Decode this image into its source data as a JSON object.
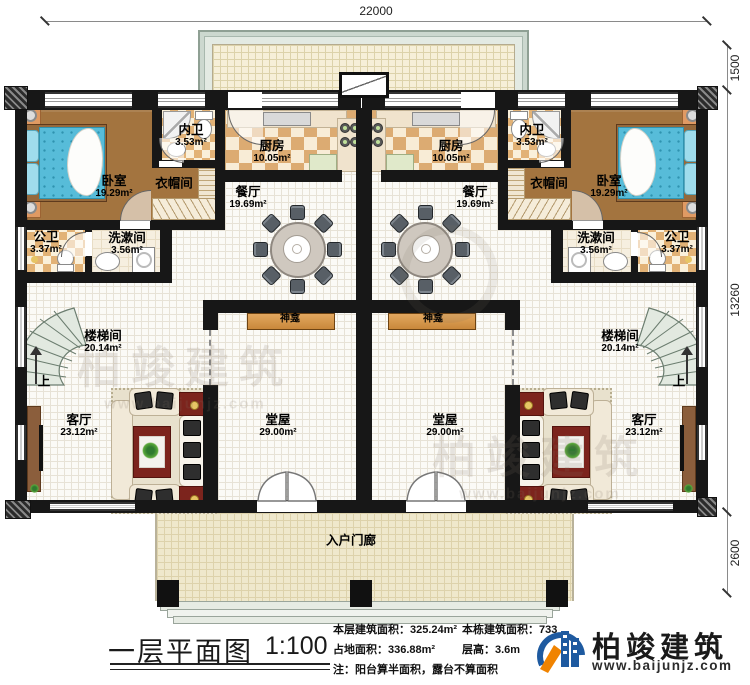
{
  "plan": {
    "title": "一层平面图",
    "scale": "1:100"
  },
  "dimensions": {
    "width_top": "22000",
    "terrace_depth": "1500",
    "body_height": "13260",
    "porch_depth": "2600"
  },
  "rooms": {
    "bedroom": {
      "name": "卧室",
      "area": "19.29m²"
    },
    "inner_bath": {
      "name": "内卫",
      "area": "3.53m²"
    },
    "cloakroom": {
      "name": "衣帽间"
    },
    "kitchen": {
      "name": "厨房",
      "area": "10.05m²"
    },
    "dining": {
      "name": "餐厅",
      "area": "19.69m²"
    },
    "public_bath": {
      "name": "公卫",
      "area": "3.37m²"
    },
    "washroom": {
      "name": "洗漱间",
      "area": "3.56m²"
    },
    "stairwell": {
      "name": "楼梯间",
      "area": "20.14m²"
    },
    "living": {
      "name": "客厅",
      "area": "23.12m²"
    },
    "hall": {
      "name": "堂屋",
      "area": "29.00m²"
    },
    "shrine": {
      "name": "神龛"
    },
    "entry_porch": {
      "name": "入户门廊"
    },
    "stair_up": "上"
  },
  "stats": {
    "floor_area": "本层建筑面积：325.24m²",
    "building_area": "本栋建筑面积：733",
    "land_area": "占地面积：336.88m²",
    "floor_height": "层高：3.6m",
    "note": "注：阳台算半面积，露台不算面积"
  },
  "branding": {
    "company": "柏竣建筑",
    "website": "www.baijunjz.com"
  },
  "watermark": {
    "text": "柏竣建筑",
    "sub": "www.baijunjz.com"
  },
  "colors": {
    "wall": "#171717",
    "checker": "#dcab72",
    "bed": "#57bcd9",
    "brand_blue": "#1e5aa0",
    "brand_orange": "#f08300"
  }
}
